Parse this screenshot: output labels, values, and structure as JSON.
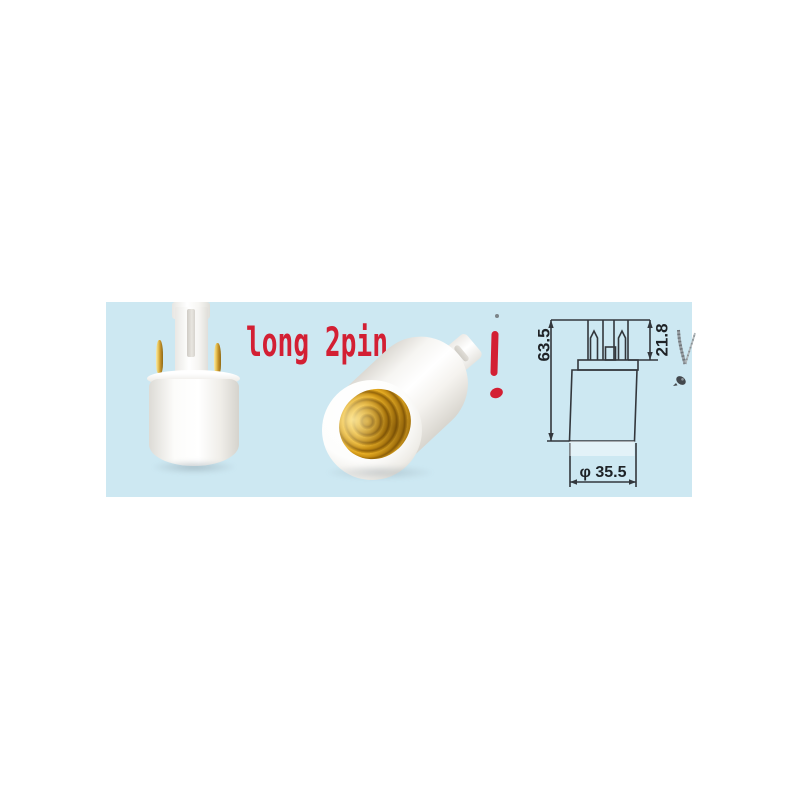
{
  "scene": {
    "background": "#ffffff",
    "band_color": "#cde8f2",
    "accent_red": "#d31f33",
    "gold_color": "#c88e14",
    "line_color": "#33373c"
  },
  "annotations": {
    "label": "long 2pin",
    "exclamation": "!"
  },
  "drawing": {
    "height_label": "63.5",
    "pin_label": "21.8",
    "diameter_label": "φ 35.5"
  }
}
